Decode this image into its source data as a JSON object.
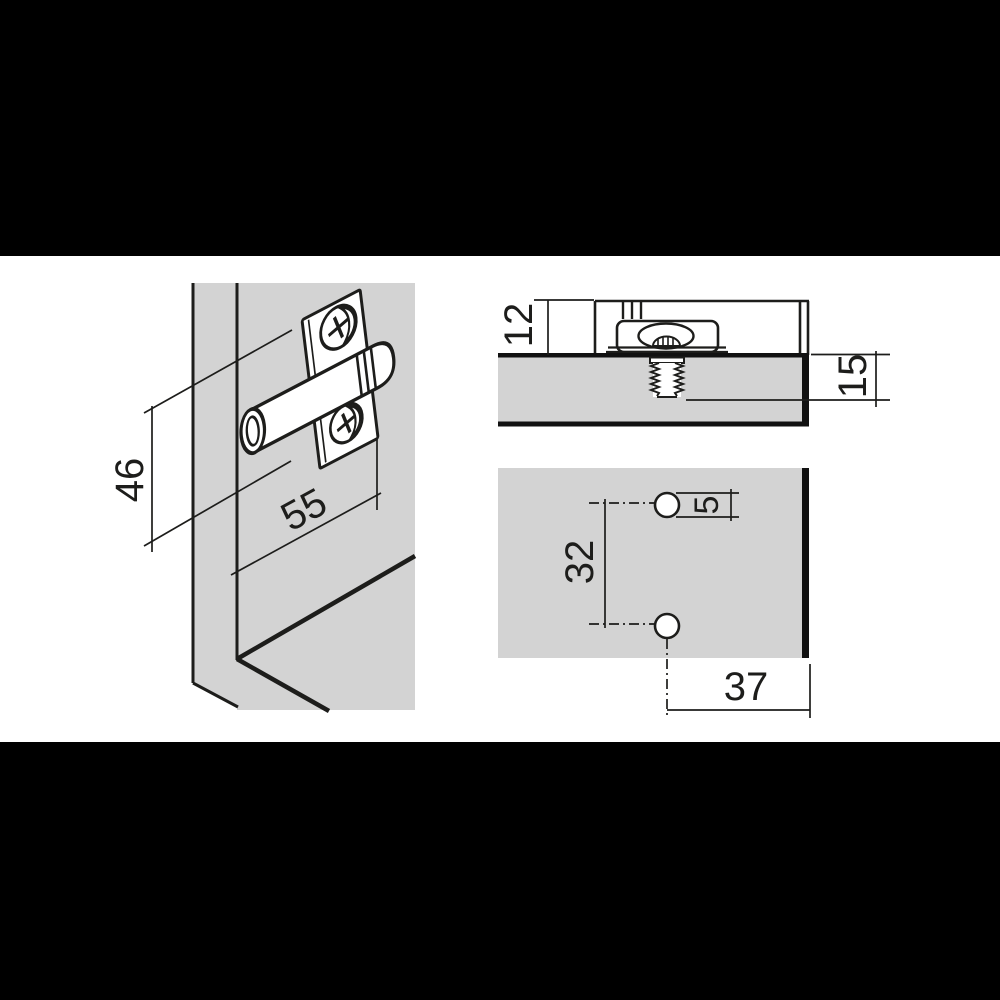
{
  "drawing": {
    "type": "technical-installation-diagram",
    "subject": "cabinet fitting / mounting plate with dowel, screw section and drilling pattern",
    "colors": {
      "background": "#ffffff",
      "letterbox_bar": "#000000",
      "panel_gray": "#d3d3d3",
      "line": "#1d1d1b"
    },
    "views": {
      "perspective": {
        "dim_height": "46",
        "dim_depth": "55"
      },
      "section": {
        "dim_plate_height": "12",
        "dim_screw_depth": "15"
      },
      "drilling": {
        "dim_hole_spacing": "32",
        "dim_hole_diameter": "5",
        "dim_edge_distance": "37"
      }
    }
  }
}
